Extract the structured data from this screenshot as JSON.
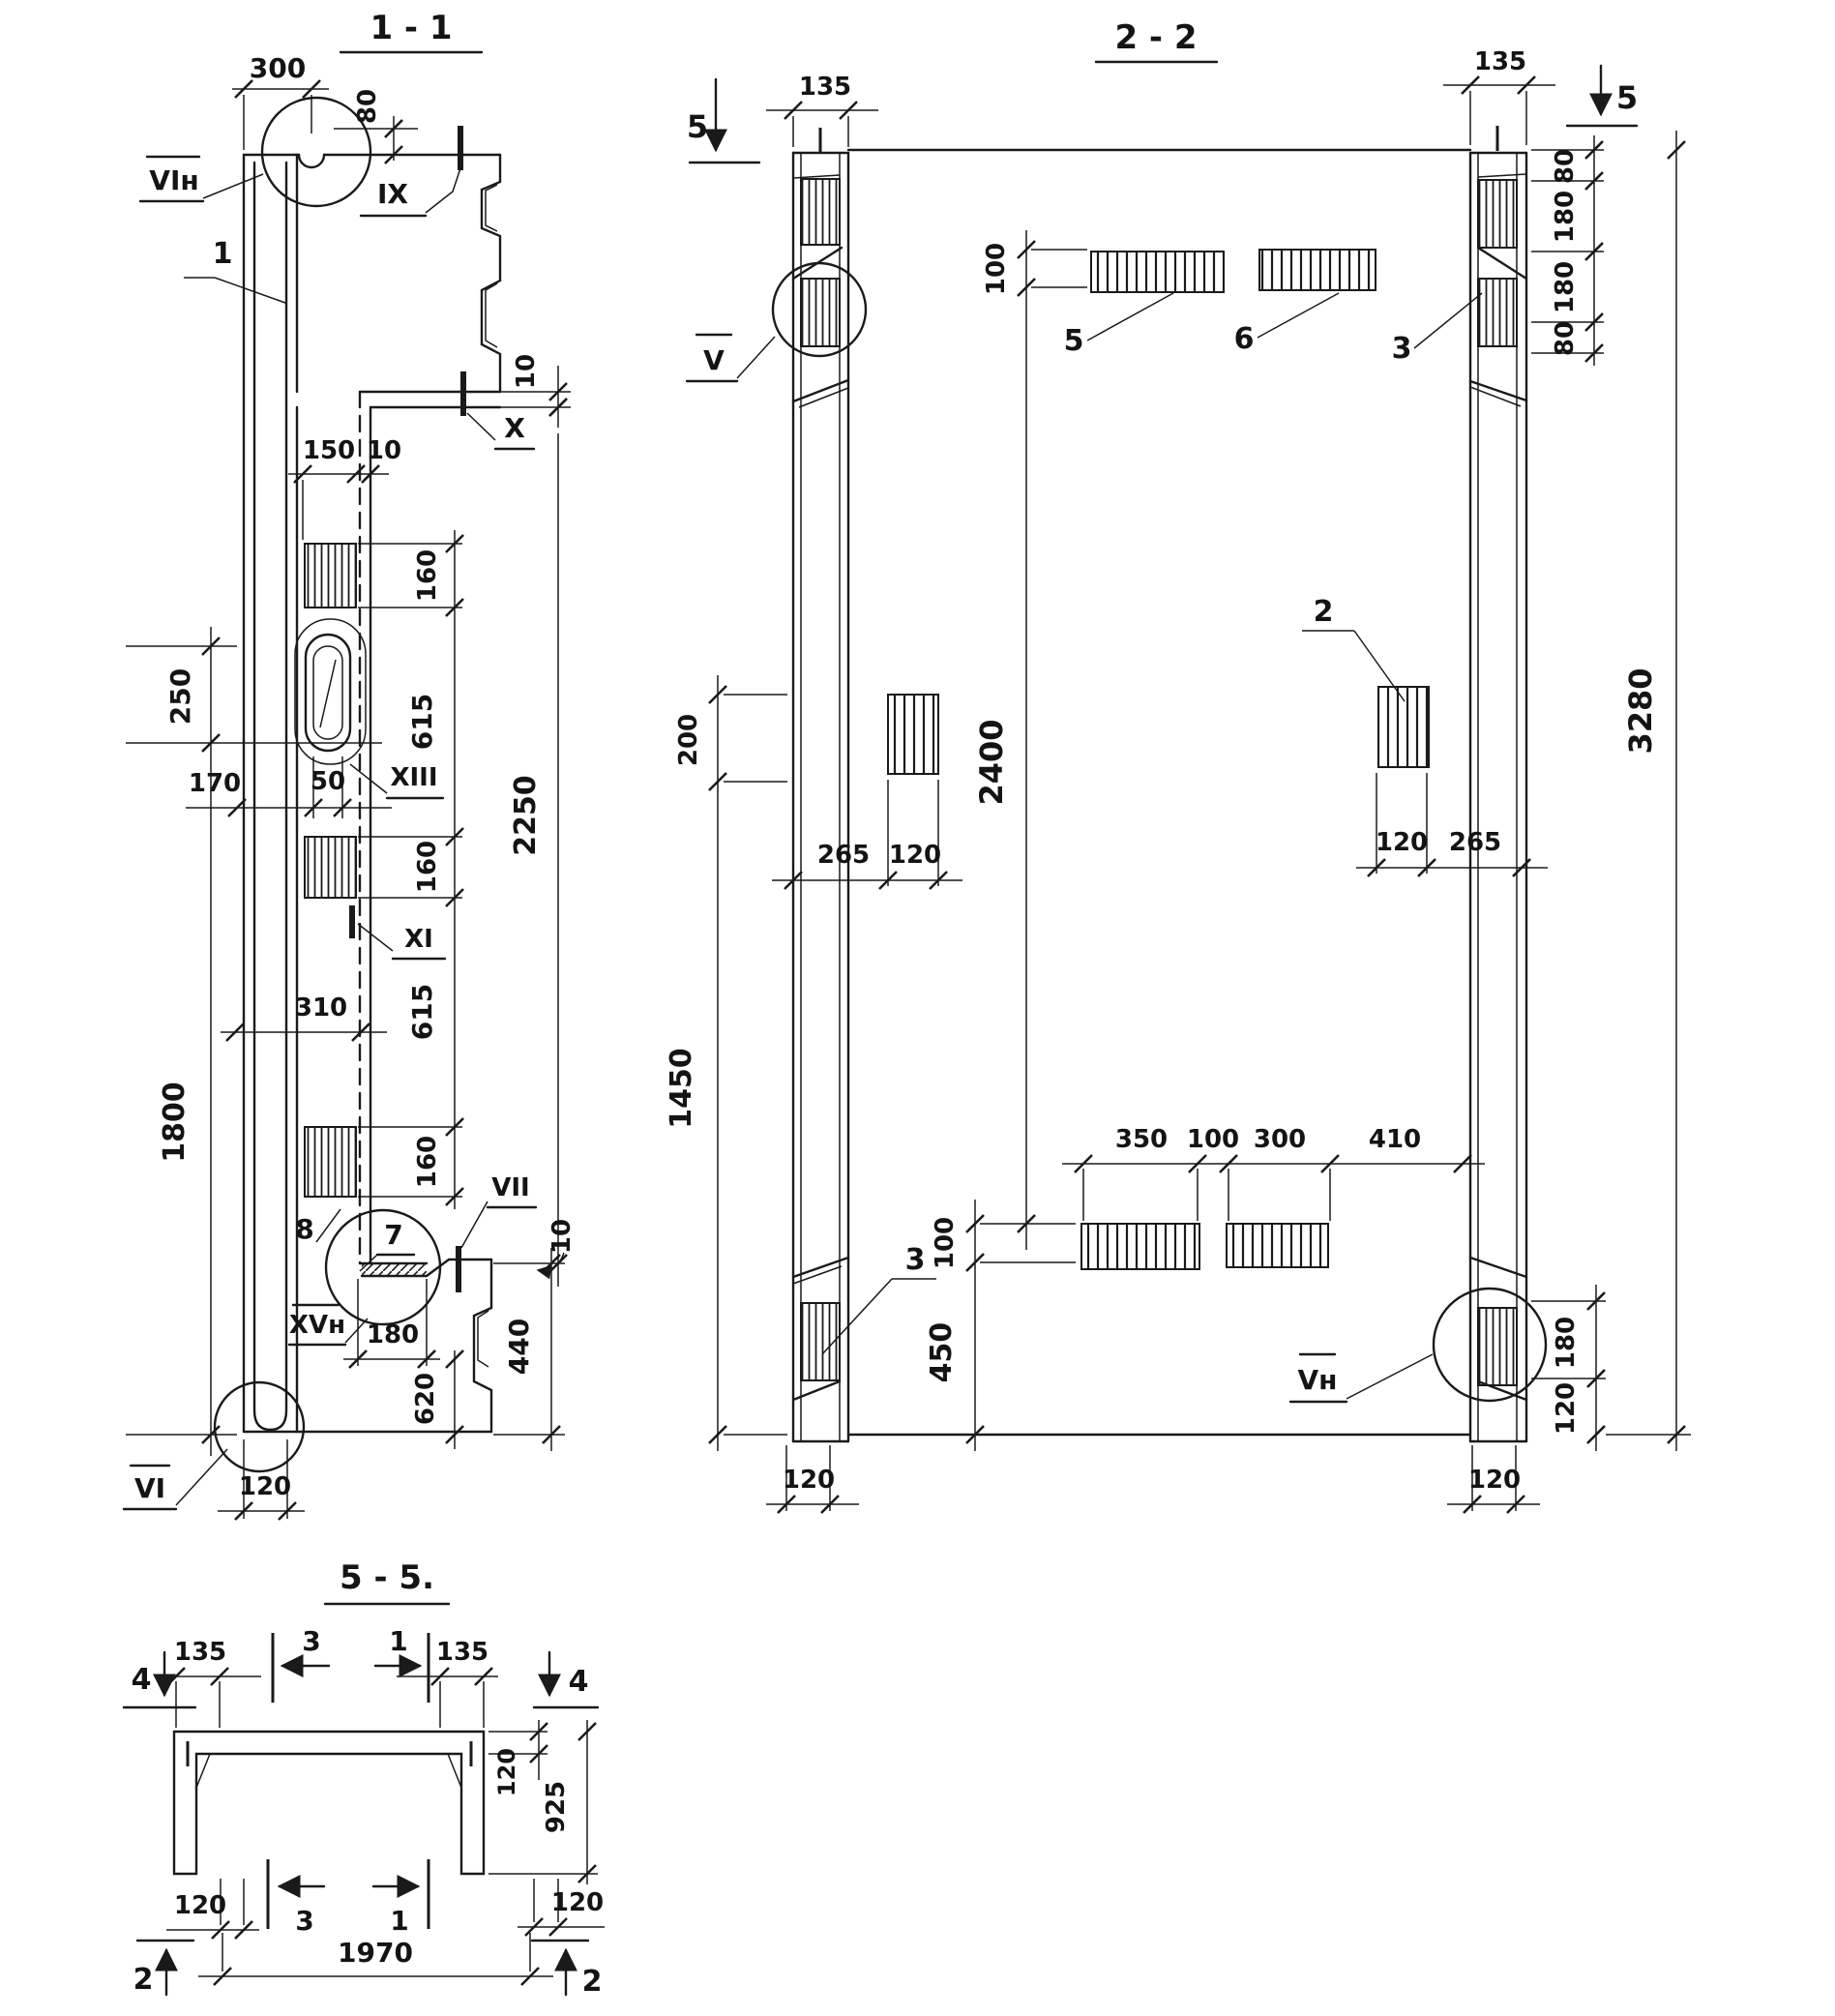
{
  "drawing": {
    "line_color": "#1a1a1a",
    "s11": {
      "title": "1 - 1",
      "d300": "300",
      "d80": "80",
      "d10t": "10",
      "lvin": "VIн",
      "lix": "IX",
      "l1": "1",
      "lx": "X",
      "d150": "150",
      "d10m": "10",
      "d160a": "160",
      "d615a": "615",
      "d160b": "160",
      "d615b": "615",
      "d160c": "160",
      "d2250": "2250",
      "d250": "250",
      "d170": "170",
      "d50": "50",
      "lxiii": "XIII",
      "lxi": "XI",
      "d310": "310",
      "d1800": "1800",
      "l8": "8",
      "l7": "7",
      "lxvn": "XVн",
      "lvii": "VII",
      "d10j": "10",
      "d440": "440",
      "d180": "180",
      "d620": "620",
      "lvi": "VI",
      "d120": "120"
    },
    "s22": {
      "title": "2 - 2",
      "m5l": "5",
      "m5r": "5",
      "d135l": "135",
      "d135r": "135",
      "d80a": "80",
      "d180a": "180",
      "d180b": "180",
      "d80b": "80",
      "d3280": "3280",
      "d200": "200",
      "d1450": "1450",
      "d100t": "100",
      "d2400": "2400",
      "d100b": "100",
      "d450": "450",
      "d265l": "265",
      "d120l": "120",
      "d120r": "120",
      "d265r": "265",
      "d350": "350",
      "d100c": "100",
      "d300": "300",
      "d410": "410",
      "d180r": "180",
      "d120br": "120",
      "d120cl": "120",
      "d120cr": "120",
      "lv": "V",
      "l5": "5",
      "l6": "6",
      "l3t": "3",
      "l2": "2",
      "l3b": "3",
      "lvn": "Vн"
    },
    "s55": {
      "title": "5 - 5.",
      "m4l": "4",
      "m4r": "4",
      "m2l": "2",
      "m2r": "2",
      "a3t": "3",
      "a1t": "1",
      "a3b": "3",
      "a1b": "1",
      "d135l": "135",
      "d135r": "135",
      "d120s": "120",
      "d925": "925",
      "d120bl": "120",
      "d120br": "120",
      "d1970": "1970"
    }
  }
}
